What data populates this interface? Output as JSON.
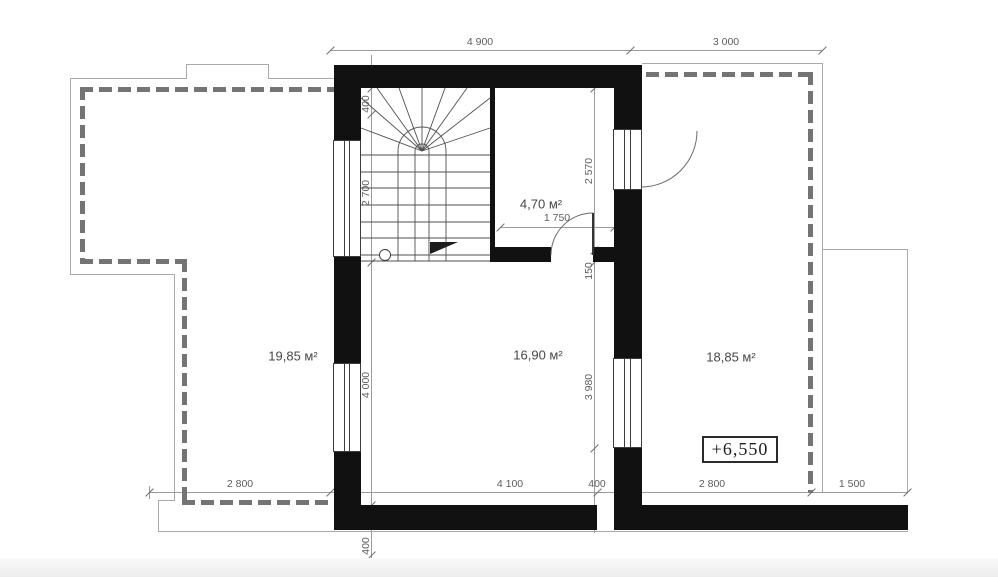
{
  "plan": {
    "areas": {
      "left_terrace": "19,85 м²",
      "hall": "16,90 м²",
      "right_terrace": "18,85 м²",
      "wc": "4,70 м²"
    },
    "level_mark": "+6,550",
    "dims": {
      "top_4900": "4 900",
      "top_3000": "3 000",
      "bottom_2800a": "2 800",
      "bottom_4100": "4 100",
      "bottom_400": "400",
      "bottom_2800b": "2 800",
      "bottom_1500": "1 500",
      "stair_400": "400",
      "stair_2700": "2 700",
      "left_4000": "4 000",
      "bottom_wall_400": "400",
      "wc_2570": "2 570",
      "jog_150": "150",
      "right_3980": "3 980",
      "door_1750": "1 750"
    }
  }
}
